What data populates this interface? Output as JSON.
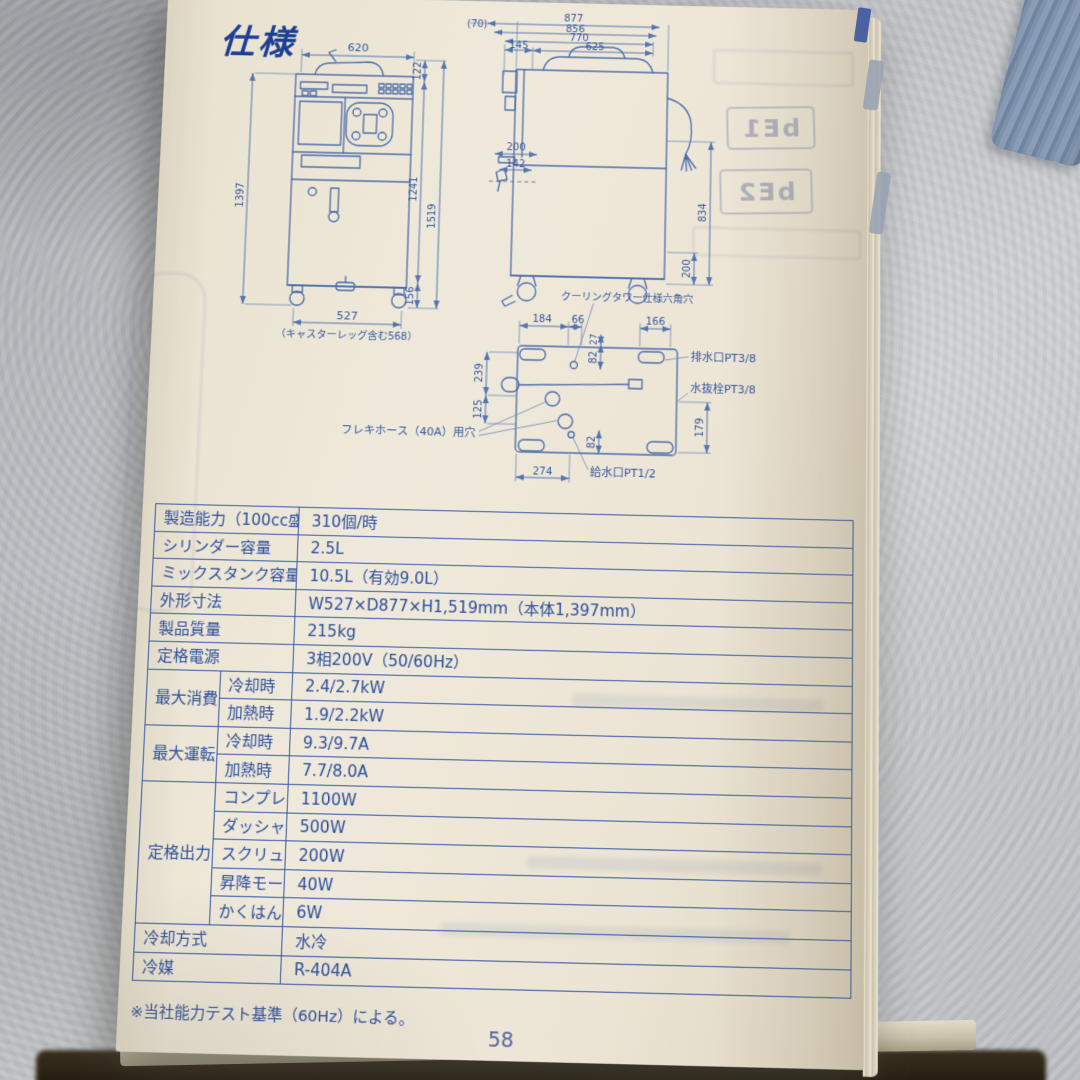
{
  "page": {
    "title": "仕様",
    "footnote": "※当社能力テスト基準（60Hz）による。",
    "page_number": "58"
  },
  "diagram": {
    "front": {
      "w_top": "620",
      "h_head": "122",
      "h_body": "1241",
      "h_total": "1519",
      "h_left": "1397",
      "h_caster": "156",
      "w_bottom": "527",
      "caption": "（キャスターレッグ含む568）"
    },
    "side": {
      "d_70": "(70)",
      "d_877": "877",
      "d_856": "856",
      "d_770": "770",
      "d_145": "145",
      "d_625": "625",
      "d_200": "200",
      "d_142": "142",
      "h_834": "834",
      "h_200": "200"
    },
    "plan": {
      "d_184": "184",
      "d_66": "66",
      "d_166": "166",
      "d_27": "27",
      "d_82a": "82",
      "d_239": "239",
      "d_125": "125",
      "d_82b": "82",
      "d_179": "179",
      "d_274": "274",
      "label_cooling": "クーリングタワー仕様六角穴",
      "label_drain": "排水口PT3/8",
      "label_plug": "水抜栓PT3/8",
      "label_flex": "フレキホース（40A）用穴",
      "label_supply": "給水口PT1/2"
    }
  },
  "spec_table": {
    "rows": [
      {
        "label": "製造能力（100cc盛り）※",
        "value": "310個/時"
      },
      {
        "label": "シリンダー容量",
        "value": "2.5L"
      },
      {
        "label": "ミックスタンク容量",
        "value": "10.5L（有効9.0L）"
      },
      {
        "label": "外形寸法",
        "value": "W527×D877×H1,519mm（本体1,397mm）"
      },
      {
        "label": "製品質量",
        "value": "215kg"
      },
      {
        "label": "定格電源",
        "value": "3相200V（50/60Hz）"
      },
      {
        "group": "最大消費電力",
        "label": "冷却時",
        "value": "2.4/2.7kW"
      },
      {
        "label": "加熱時",
        "value": "1.9/2.2kW"
      },
      {
        "group": "最大運転電流",
        "label": "冷却時",
        "value": "9.3/9.7A"
      },
      {
        "label": "加熱時",
        "value": "7.7/8.0A"
      },
      {
        "group": "定格出力",
        "label": "コンプレッサー",
        "value": "1100W"
      },
      {
        "label": "ダッシャーモーター",
        "value": "500W"
      },
      {
        "label": "スクリューモーター",
        "value": "200W"
      },
      {
        "label": "昇降モーター",
        "value": "40W"
      },
      {
        "label": "かくはんモーター",
        "value": "6W"
      },
      {
        "label": "冷却方式",
        "value": "水冷"
      },
      {
        "label": "冷媒",
        "value": "R-404A"
      }
    ]
  },
  "bleedthrough": {
    "display1": "bE1",
    "display2": "bE2"
  }
}
